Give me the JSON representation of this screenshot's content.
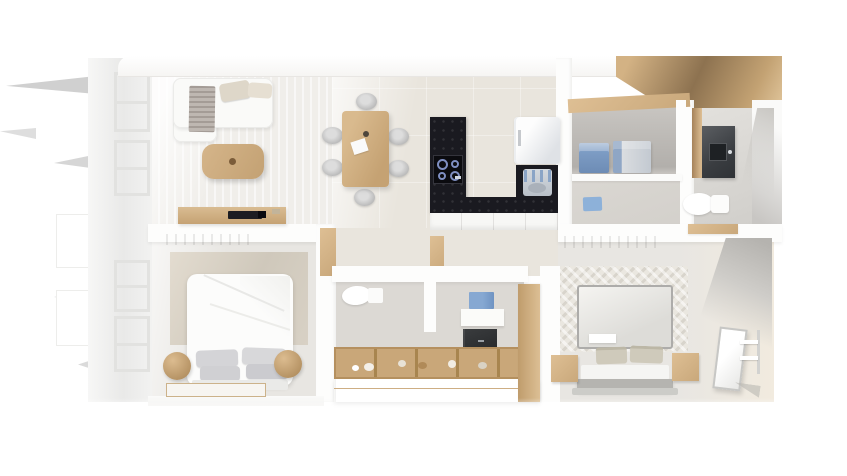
{
  "scene": {
    "type": "3d-floor-plan-top-view-render",
    "description": "Top-down 3D render of a two-bedroom apartment on a white background",
    "rooms": [
      {
        "name": "living-room",
        "furniture": [
          "sofa",
          "throw-blanket",
          "back-cushions",
          "coffee-table",
          "striped-area-rug",
          "tv-sideboard",
          "flat-tv"
        ]
      },
      {
        "name": "dining-area",
        "furniture": [
          "wood-dining-table",
          "six-gray-chairs",
          "paper-sheet",
          "cup"
        ]
      },
      {
        "name": "kitchen",
        "furniture": [
          "l-shaped-dark-stone-counter",
          "cooktop",
          "white-base-cabinets",
          "fridge",
          "sink-unit"
        ]
      },
      {
        "name": "laundry-room",
        "furniture": [
          "washer",
          "dryer",
          "wood-topped-niche",
          "blue-floor-mat"
        ]
      },
      {
        "name": "bathroom-main",
        "furniture": [
          "dark-vanity-with-basin",
          "toilet",
          "wood-bench"
        ]
      },
      {
        "name": "bedroom-primary",
        "furniture": [
          "double-bed-white-duvet",
          "gray-pillows",
          "headboard-panel",
          "two-wood-poufs",
          "bordered-rug",
          "wood-wall-shelf"
        ]
      },
      {
        "name": "ensuite-bathroom",
        "furniture": [
          "toilet",
          "blue-wall-cabinet",
          "washbasin-counter",
          "dark-base-cabinet"
        ]
      },
      {
        "name": "walk-in-closet",
        "furniture": [
          "wood-wardrobe-island",
          "folded-clothes",
          "wood-side-panel"
        ]
      },
      {
        "name": "bedroom-secondary",
        "furniture": [
          "double-bed-gray-duvet",
          "beige-pillows",
          "two-wood-nightstands",
          "herringbone-rug",
          "mirror-panel",
          "white-shelf-unit",
          "wood-wall-shelf"
        ]
      }
    ],
    "exterior": [
      "left-facade-windows",
      "open-window-flaps",
      "top-right-wood-pergola-beam"
    ]
  },
  "palette": {
    "background": "#ffffff",
    "wallWhite": "#fdfdfc",
    "exteriorGray": "#ececeb",
    "floorLiving": "#f0eeea",
    "floorDining": "#e9e5dd",
    "floorGray": "#dcd9d4",
    "floorBedroom": "#e8e6e2",
    "wood": "#c9a87b",
    "woodLight": "#debf94",
    "woodDark": "#a5825a",
    "counterDark": "#1a1a20",
    "tvDark": "#1d1d22",
    "applianceBlue": "#7b9fcb",
    "applianceSilver": "#c7ccd2",
    "vanityDark": "#3a3d41",
    "textileGray": "#d4d4d7",
    "pillowBeige": "#cfcabb",
    "sofaWhite": "#fafaf8",
    "matBlue": "#8db1d9"
  }
}
